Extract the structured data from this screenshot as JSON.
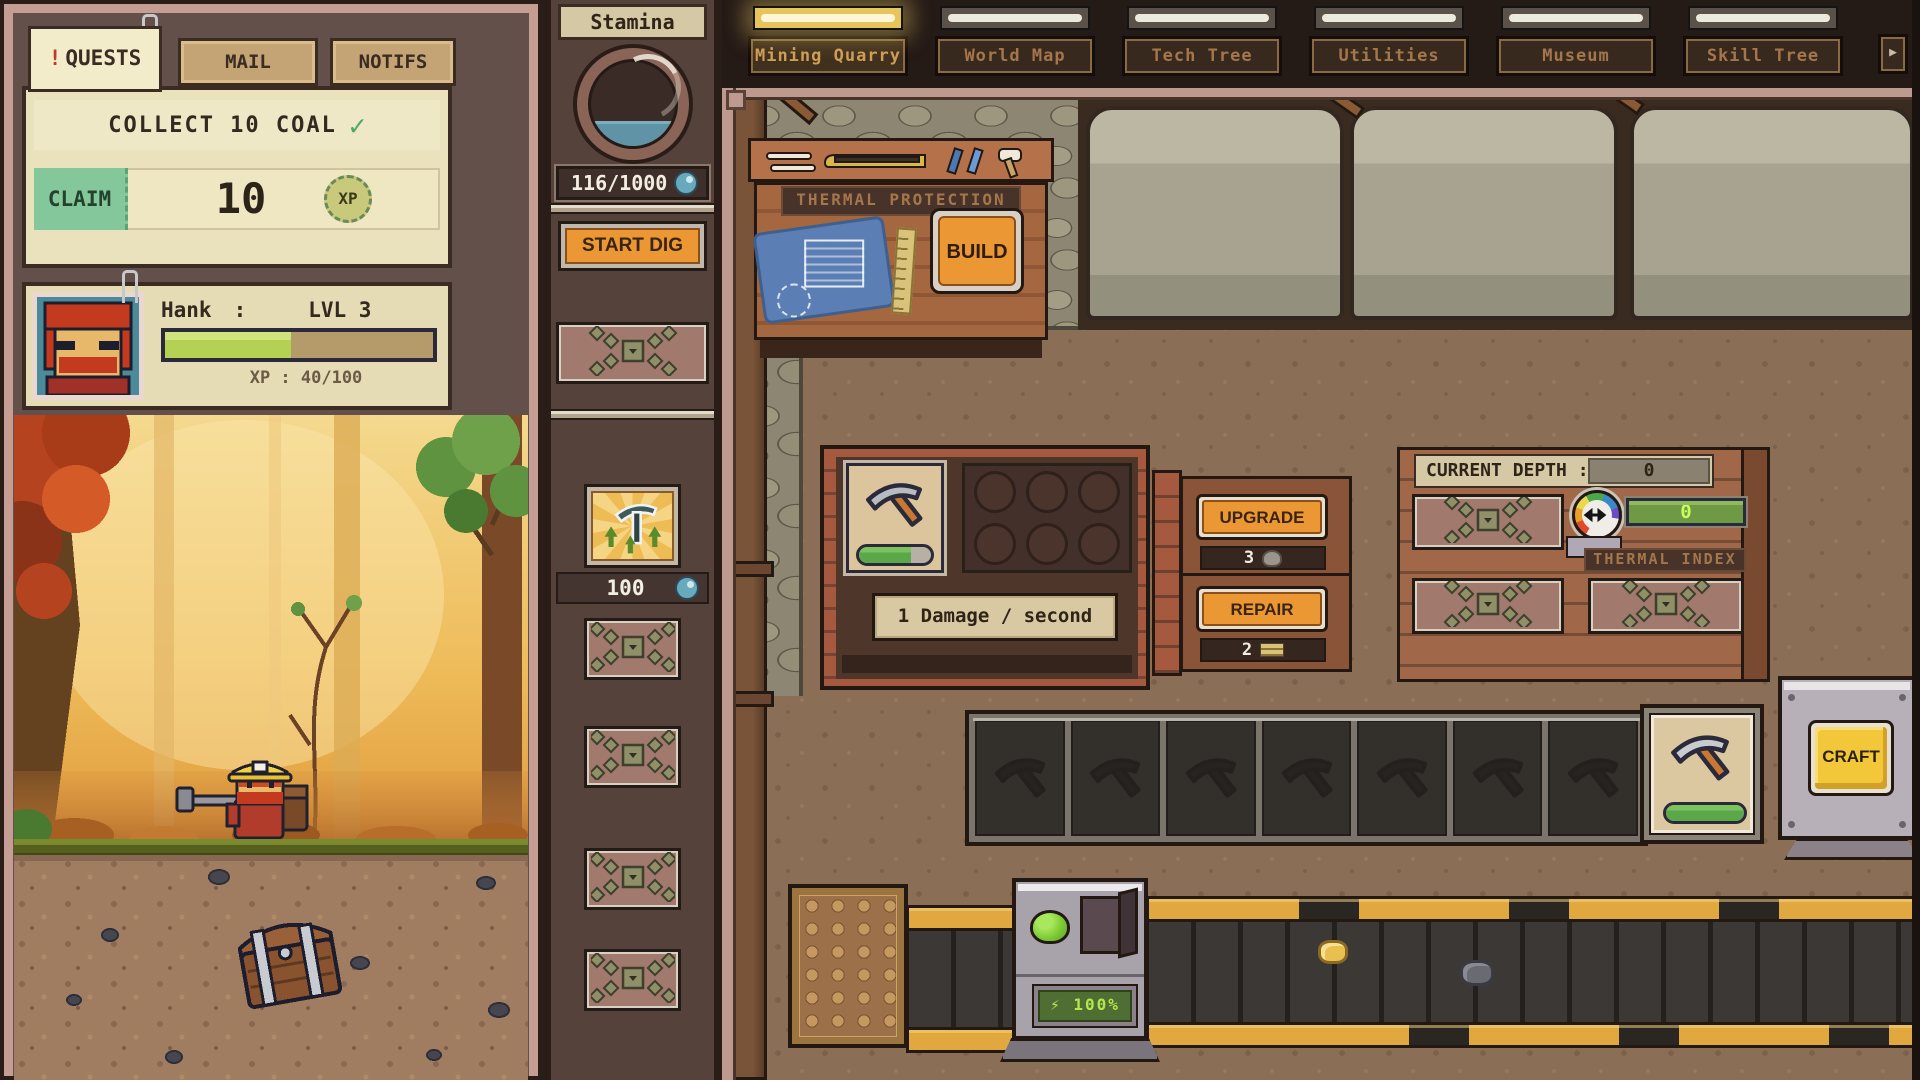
{
  "colors": {
    "accent_orange": "#ea9734",
    "claim_green": "#83c79b",
    "xp_fill": "#b5d154",
    "stamina_liquid": "#5f93a5",
    "craft_yellow": "#f2c83a",
    "lcd_green": "#b4e84a",
    "sign_text": "#a5764a"
  },
  "left_panel": {
    "tabs": [
      {
        "label": "QUESTS",
        "badge": "!",
        "active": true
      },
      {
        "label": "MAIL",
        "active": false
      },
      {
        "label": "NOTIFS",
        "active": false
      }
    ],
    "quest": {
      "title": "COLLECT 10 COAL",
      "check": "✓",
      "claim_label": "CLAIM",
      "reward_amount": "10",
      "reward_unit": "XP"
    },
    "player": {
      "name": "Hank",
      "separator": ":",
      "level": "LVL 3",
      "xp_text": "XP : 40/100",
      "xp_percent": 47
    }
  },
  "stamina_panel": {
    "title": "Stamina",
    "value": "116/1000",
    "fill_percent": 13,
    "dig_button": "START DIG",
    "upgrade_item_count": "100"
  },
  "nav": {
    "tabs": [
      {
        "label": "Mining Quarry",
        "active": true
      },
      {
        "label": "World Map",
        "active": false
      },
      {
        "label": "Tech Tree",
        "active": false
      },
      {
        "label": "Utilities",
        "active": false
      },
      {
        "label": "Museum",
        "active": false
      },
      {
        "label": "Skill Tree",
        "active": false
      }
    ],
    "more_arrow": "▶"
  },
  "workshop": {
    "sign": "THERMAL PROTECTION",
    "build_button": "BUILD"
  },
  "pickaxe_station": {
    "tooltip": "1 Damage / second",
    "upgrade_button": "UPGRADE",
    "upgrade_cost": "3",
    "repair_button": "REPAIR",
    "repair_cost": "2",
    "durability_percent": 72
  },
  "depth_panel": {
    "label": "CURRENT DEPTH :",
    "value": "0",
    "thermal_label": "THERMAL INDEX",
    "thermal_value": "0"
  },
  "crafting": {
    "craft_button": "CRAFT",
    "result_durability_percent": 100
  },
  "machine": {
    "power_icon": "⚡",
    "power_value": "100%"
  },
  "counts": {
    "inventory_slots": 4,
    "queue_slots": 7,
    "upgrade_sockets": 6,
    "boulders": 3
  }
}
